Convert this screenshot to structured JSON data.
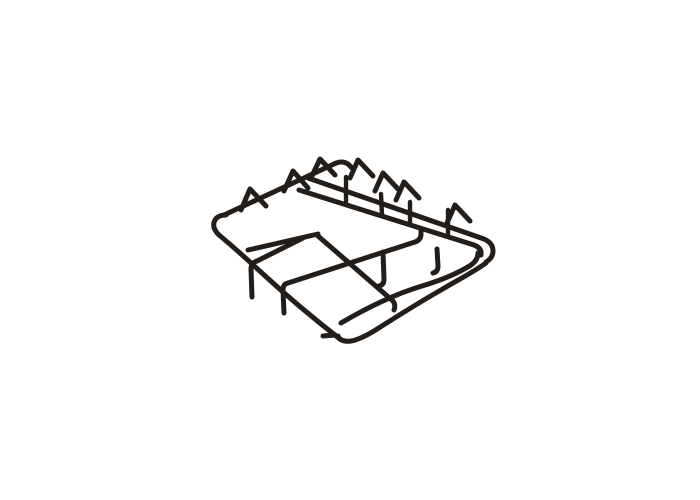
{
  "photo": {
    "type": "product-photo",
    "subject": "Black enamelled wire gas hob pan support trivet with two burner sections and raised finger prongs, photographed at an angle on a plain white background",
    "background_color": "#ffffff",
    "wire_color": "#241e1b",
    "wire_highlight_color": "#5a4d45"
  }
}
